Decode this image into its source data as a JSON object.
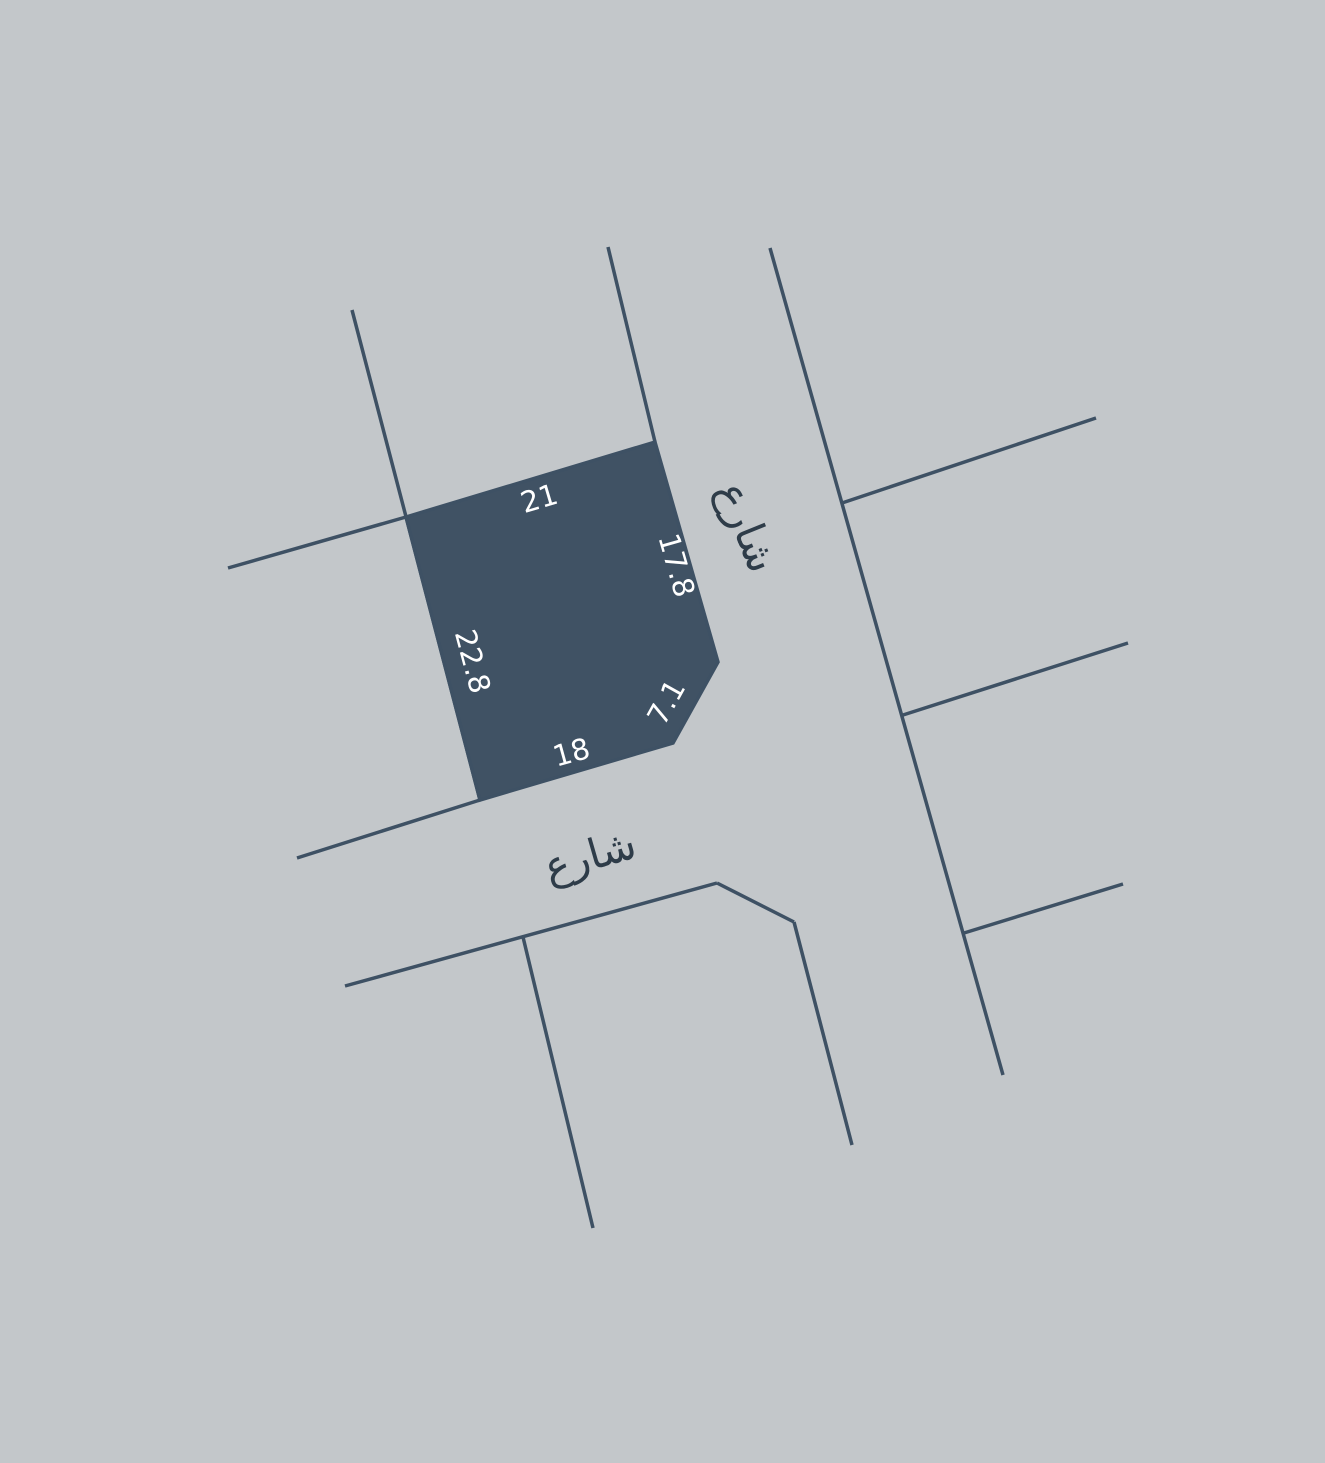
{
  "map": {
    "background_color": "#c3c7ca",
    "boundary_line_color": "#3e5164",
    "street_label_color": "#2e3c49",
    "parcel": {
      "fill_color": "#405264",
      "label_color": "#ffffff",
      "edges": [
        {
          "side": "top",
          "length_label": "21"
        },
        {
          "side": "right",
          "length_label": "17.8"
        },
        {
          "side": "chamfer",
          "length_label": "7.1"
        },
        {
          "side": "bottom",
          "length_label": "18"
        },
        {
          "side": "left",
          "length_label": "22.8"
        }
      ]
    },
    "streets": [
      {
        "name": "شارع",
        "position": "right-road-vertical"
      },
      {
        "name": "شارع",
        "position": "bottom-road-horizontal"
      }
    ]
  }
}
